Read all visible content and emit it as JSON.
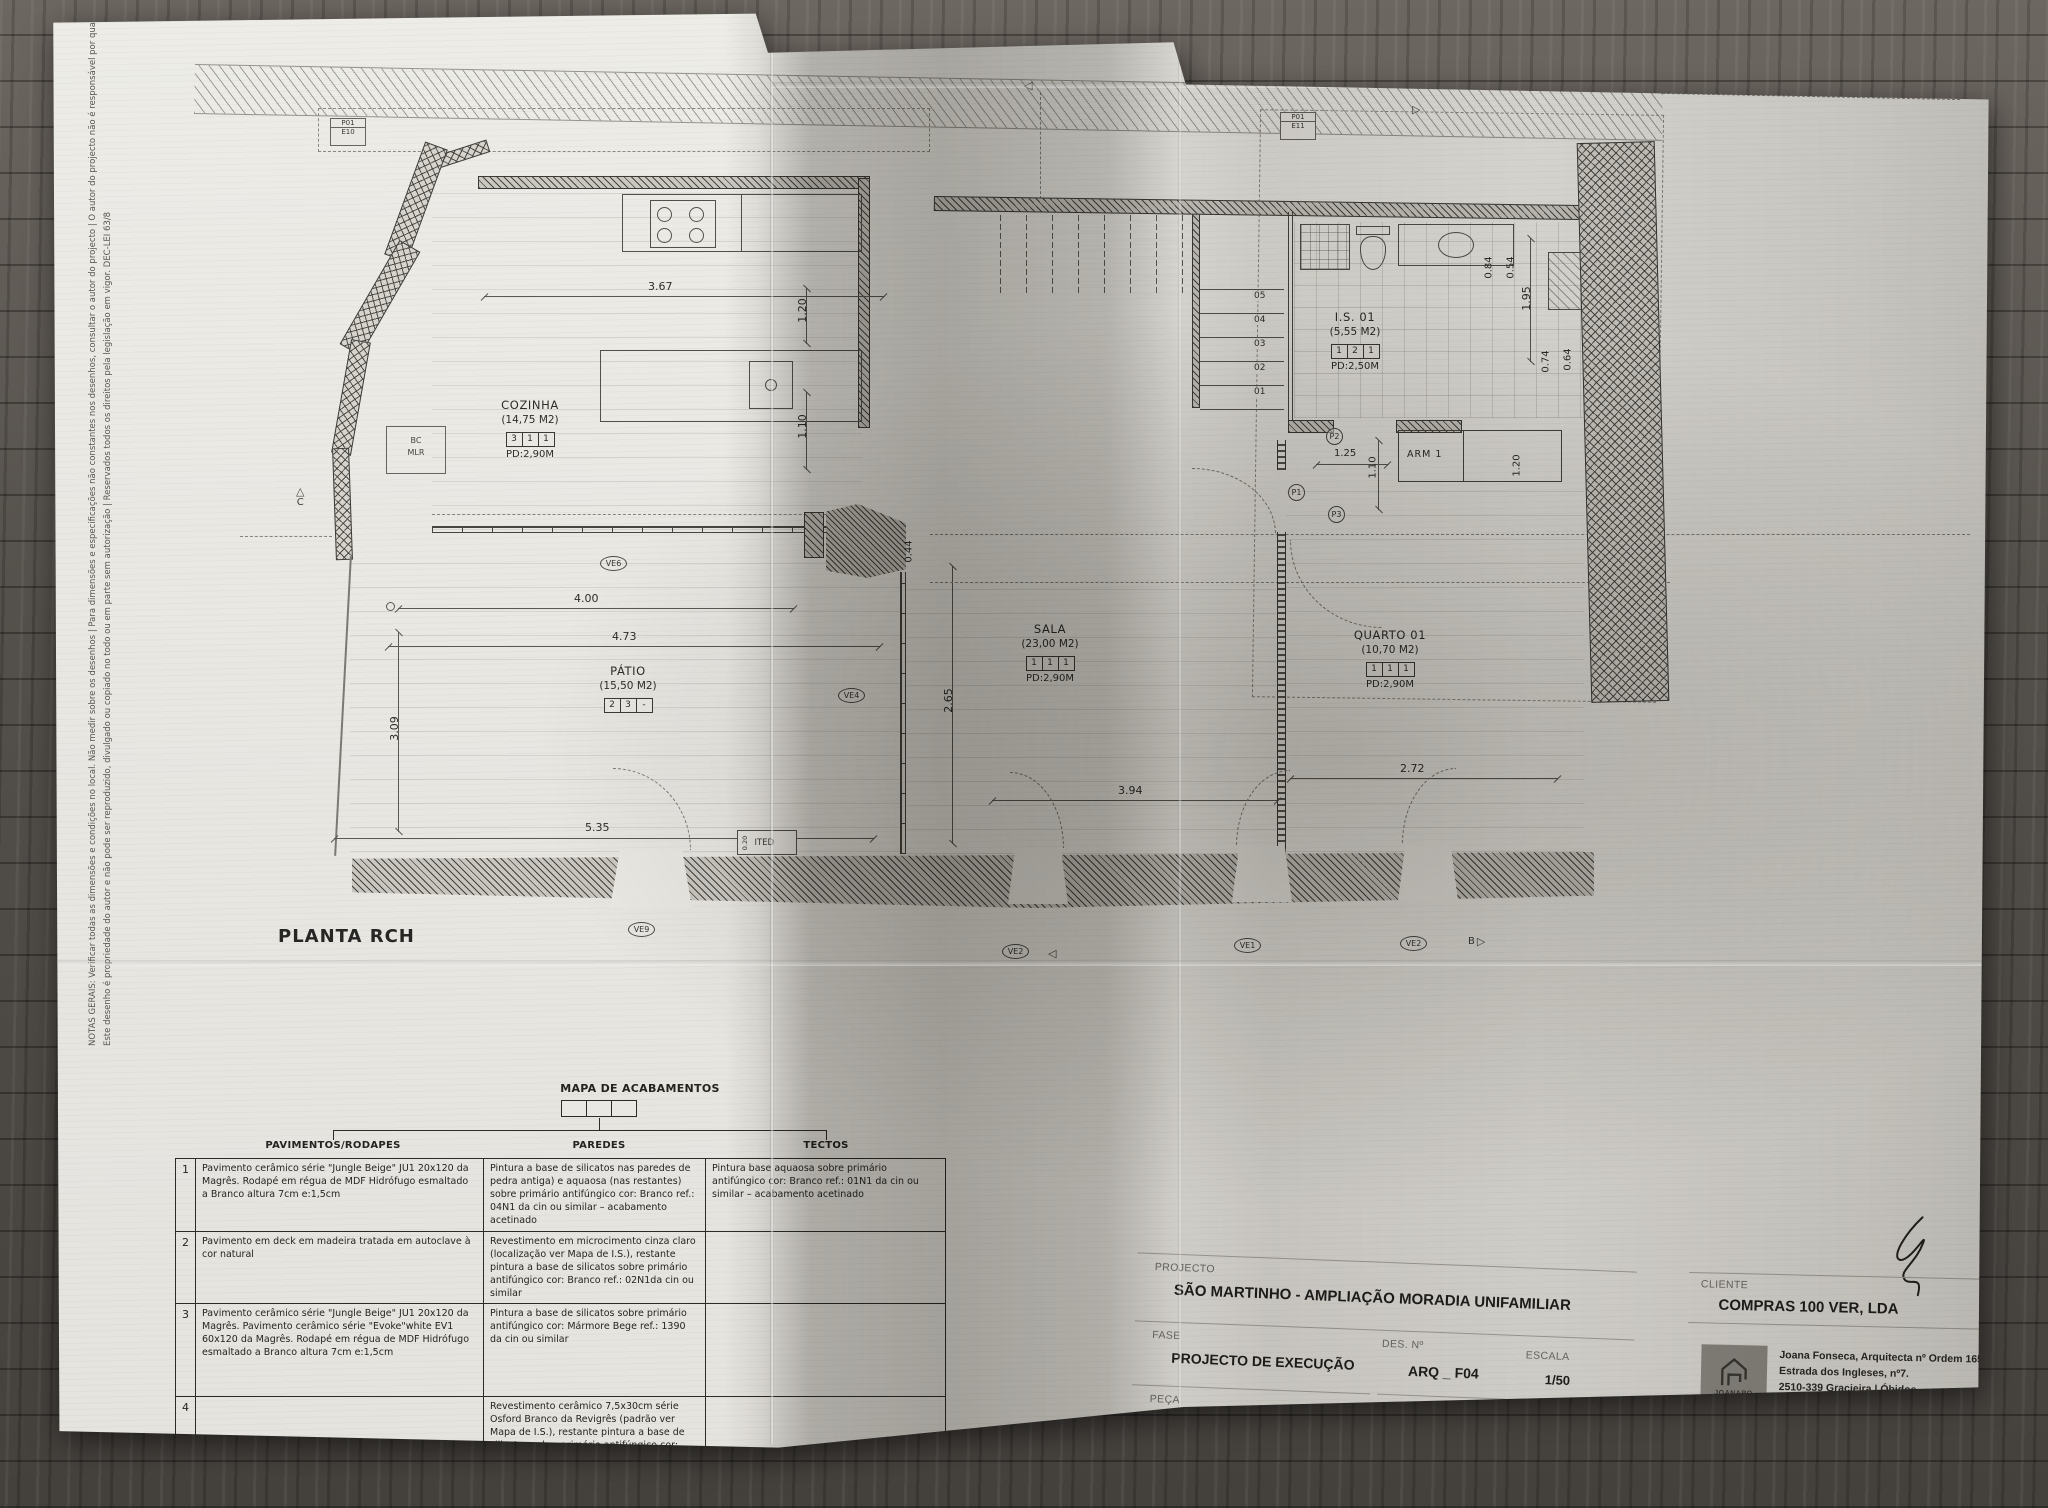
{
  "sheet": {
    "caption": "PLANTA RCH",
    "notes": {
      "line1": "NOTAS GERAIS: Verificar todas as dimensões e condições no local. Não medir sobre os desenhos | Para dimensões e especificações não constantes nos desenhos, consultar o autor do projecto | O autor do projecto não é responsável por quaisquer revisões ao projecto original.",
      "line2": "Este desenho é propriedade do autor e não pode ser reproduzido, divulgado ou copiado no todo ou em parte sem autorização | Reservados todos os direitos pela legislação em vigor. DEC-LEI 63/8"
    }
  },
  "plan": {
    "rooms": {
      "cozinha": {
        "name": "COZINHA",
        "area": "(14,75 M2)",
        "c1": "3",
        "c2": "1",
        "c3": "1",
        "pd": "PD:2,90M"
      },
      "patio": {
        "name": "PÁTIO",
        "area": "(15,50 M2)",
        "c1": "2",
        "c2": "3",
        "c3": "-",
        "pd": ""
      },
      "sala": {
        "name": "SALA",
        "area": "(23,00 M2)",
        "c1": "1",
        "c2": "1",
        "c3": "1",
        "pd": "PD:2,90M"
      },
      "quarto": {
        "name": "QUARTO 01",
        "area": "(10,70 M2)",
        "c1": "1",
        "c2": "1",
        "c3": "1",
        "pd": "PD:2,90M"
      },
      "is01": {
        "name": "I.S. 01",
        "area": "(5,55 M2)",
        "c1": "1",
        "c2": "2",
        "c3": "1",
        "pd": "PD:2,50M"
      },
      "arm": {
        "name": "ARM 1"
      }
    },
    "dims": {
      "d367": "3.67",
      "d120a": "1.20",
      "d110a": "1.10",
      "d400": "4.00",
      "d473": "4.73",
      "d535": "5.35",
      "d309": "3.09",
      "d265": "2.65",
      "d044": "0.44",
      "d394": "3.94",
      "d272": "2.72",
      "d195": "1.95",
      "d084": "0.84",
      "d054": "0.54",
      "d074": "0.74",
      "d064": "0.64",
      "d125": "1.25",
      "d110b": "1.10",
      "d120b": "1.20",
      "d020": "0.20"
    },
    "steps": [
      "05",
      "04",
      "03",
      "02",
      "01"
    ],
    "tags": {
      "ve6": "VE6",
      "ve4": "VE4",
      "ve9": "VE9",
      "ve2a": "VE2",
      "ve1": "VE1",
      "ve2b": "VE2",
      "ve3": "VE3",
      "p1": "P1",
      "p2": "P2",
      "p3": "P3"
    },
    "ref_boxes": {
      "b1l1": "P01",
      "b1l2": "E10",
      "b2l1": "P01",
      "b2l2": "E11"
    },
    "misc": {
      "bc1": "BC",
      "bc2": "MLR",
      "ited": "ITED",
      "sec_c": "C",
      "sec_b": "B",
      "tri": "△",
      "tri_l": "◁",
      "tri_r": "▷"
    }
  },
  "finish_table": {
    "title": "MAPA DE ACABAMENTOS",
    "columns": [
      "PAVIMENTOS/RODAPES",
      "PAREDES",
      "TECTOS"
    ],
    "rows": [
      {
        "n": "1",
        "pavimentos": "Pavimento cerâmico série \"Jungle Beige\" JU1 20x120 da Magrês. Rodapé em régua de MDF Hidrófugo esmaltado a Branco altura 7cm e:1,5cm",
        "paredes": "Pintura a base de silicatos nas paredes de pedra antiga) e aquaosa (nas restantes) sobre primário antifúngico cor: Branco ref.: 04N1 da cin ou similar – acabamento acetinado",
        "tectos": "Pintura base aquaosa sobre primário antifúngico cor: Branco ref.: 01N1 da cin ou similar – acabamento acetinado"
      },
      {
        "n": "2",
        "pavimentos": "Pavimento em deck em madeira tratada em autoclave à cor natural",
        "paredes": "Revestimento em microcimento cinza claro (localização ver Mapa de I.S.), restante pintura a base de silicatos sobre primário antifúngico cor: Branco ref.: 02N1da cin ou similar",
        "tectos": ""
      },
      {
        "n": "3",
        "pavimentos": "Pavimento cerâmico série \"Jungle Beige\" JU1 20x120 da Magrês. Pavimento cerâmico série \"Evoke\"white EV1 60x120 da Magrês. Rodapé em régua de MDF Hidrófugo esmaltado a Branco altura 7cm e:1,5cm",
        "paredes": "Pintura a base de silicatos sobre primário antifúngico cor: Mármore Bege ref.: 1390 da cin ou similar",
        "tectos": ""
      },
      {
        "n": "4",
        "pavimentos": "",
        "paredes": "Revestimento cerâmico 7,5x30cm série Osford Branco da Revigrês (padrão ver Mapa de I.S.), restante pintura a base de silicatos sobre primário antifúngico cor: Branco ref.: 02N1da cin ou similar",
        "tectos": ""
      }
    ]
  },
  "title_block": {
    "projecto_label": "PROJECTO",
    "projecto": "SÃO MARTINHO  -  AMPLIAÇÃO  MORADIA UNIFAMILIAR",
    "fase_label": "FASE",
    "fase": "PROJECTO DE EXECUÇÃO",
    "peca_label": "PEÇA",
    "peca": "PROPOSTA - PLANTA RCH",
    "des_label": "DES. Nº",
    "des": "ARQ _ F04",
    "data_label": "DATA",
    "data": "FEVEREIRO 2024",
    "escala_label": "ESCALA",
    "escala": "1/50",
    "revisao_label": "REVISÃO",
    "revisao": "---",
    "cliente_label": "CLIENTE",
    "cliente": "COMPRAS 100 VER, LDA",
    "logo_text": "JOANARQ",
    "architect": {
      "line1": "Joana Fonseca, Arquitecta nº Ordem 16595",
      "line2": "Estrada dos Ingleses, nº7.",
      "line3": "2510-339 Gracieira | Óbidos",
      "line4": "Tel: 91 082 80 98",
      "line5": "E-mail: joanaritafonseca@gmail.com"
    }
  },
  "colors": {
    "paper": "#e9e7e2",
    "ink": "#2d2d2a",
    "wood": "#55504a"
  }
}
